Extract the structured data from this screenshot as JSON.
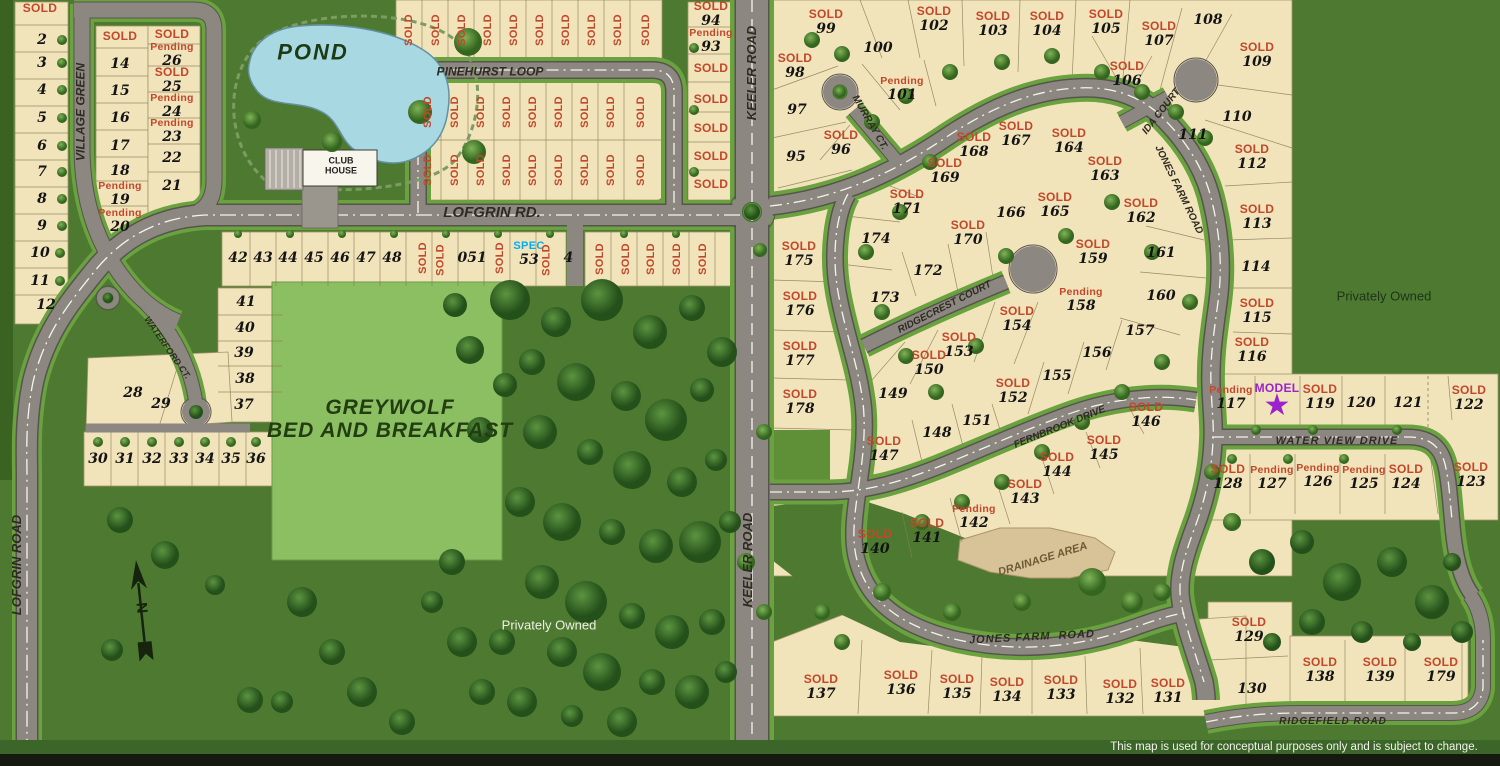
{
  "colors": {
    "background": "#4d7a30",
    "lot_fill": "#f1e3ba",
    "road": "#8d8781",
    "pond": "#a8d8e1",
    "sold": "#c2472b",
    "pending": "#c2472b",
    "spec": "#00aeef",
    "model": "#9a23cc"
  },
  "status_labels": {
    "sold": "SOLD",
    "pending": "Pending",
    "spec": "SPEC",
    "model": "MODEL"
  },
  "privately_owned": {
    "left": "Privately Owned",
    "right": "Privately Owned"
  },
  "disclaimer": "This map is used for conceptual purposes only and is subject to change.",
  "compass": "N",
  "labels": [
    {
      "t": "VILLAGE GREEN",
      "x": 81,
      "y": 112,
      "r": -90,
      "s": 12
    },
    {
      "t": "POND",
      "x": 313,
      "y": 52,
      "s": 22,
      "c": "#1d3a14",
      "sp": 2
    },
    {
      "t": "CLUB",
      "x": 341,
      "y": 161,
      "s": 9,
      "c": "#222",
      "i": false
    },
    {
      "t": "HOUSE",
      "x": 341,
      "y": 171,
      "s": 9,
      "c": "#222",
      "i": false
    },
    {
      "t": "PINEHURST LOOP",
      "x": 490,
      "y": 72,
      "s": 12
    },
    {
      "t": "LOFGRIN RD.",
      "x": 492,
      "y": 213,
      "s": 15
    },
    {
      "t": "WATERFORD CT.",
      "x": 167,
      "y": 348,
      "r": 55,
      "s": 9
    },
    {
      "t": "LOFGRIN ROAD",
      "x": 17,
      "y": 565,
      "r": -90,
      "s": 13
    },
    {
      "t": "KEELER ROAD",
      "x": 752,
      "y": 73,
      "r": -90,
      "s": 13
    },
    {
      "t": "KEELER ROAD",
      "x": 748,
      "y": 560,
      "r": -90,
      "s": 13
    },
    {
      "t": "MURRAY CT.",
      "x": 869,
      "y": 123,
      "r": 60,
      "s": 10
    },
    {
      "t": "IDA COURT",
      "x": 1162,
      "y": 112,
      "r": -52,
      "s": 10
    },
    {
      "t": "JONES FARM ROAD",
      "x": 1178,
      "y": 190,
      "r": 64,
      "s": 10
    },
    {
      "t": "RIDGECREST COURT",
      "x": 945,
      "y": 308,
      "r": -27,
      "s": 10
    },
    {
      "t": "FERNBROOK DRIVE",
      "x": 1060,
      "y": 428,
      "r": -22,
      "s": 10
    },
    {
      "t": "WATER VIEW DRIVE",
      "x": 1337,
      "y": 442,
      "s": 11,
      "sp": 1
    },
    {
      "t": "JONES FARM  ROAD",
      "x": 1032,
      "y": 638,
      "r": -3,
      "s": 11,
      "sp": 1
    },
    {
      "t": "RIDGEFIELD ROAD",
      "x": 1333,
      "y": 722,
      "s": 10,
      "sp": 1
    },
    {
      "t": "DRAINAGE AREA",
      "x": 1043,
      "y": 560,
      "r": -17,
      "s": 11,
      "c": "#6d5a35"
    },
    {
      "t": "GREYWOLF",
      "x": 390,
      "y": 408,
      "s": 21,
      "c": "#223d12",
      "sp": 1
    },
    {
      "t": "BED AND BREAKFAST",
      "x": 390,
      "y": 431,
      "s": 21,
      "c": "#223d12",
      "sp": 1
    }
  ],
  "lots": [
    {
      "s": "sold",
      "x": 40,
      "y": 8
    },
    {
      "n": "2",
      "x": 42,
      "y": 40
    },
    {
      "n": "3",
      "x": 42,
      "y": 63
    },
    {
      "n": "4",
      "x": 42,
      "y": 90
    },
    {
      "n": "5",
      "x": 42,
      "y": 118
    },
    {
      "n": "6",
      "x": 42,
      "y": 146
    },
    {
      "n": "7",
      "x": 42,
      "y": 172
    },
    {
      "n": "8",
      "x": 42,
      "y": 199
    },
    {
      "n": "9",
      "x": 42,
      "y": 226
    },
    {
      "n": "10",
      "x": 40,
      "y": 253
    },
    {
      "n": "11",
      "x": 40,
      "y": 281
    },
    {
      "n": "12",
      "x": 46,
      "y": 305
    },
    {
      "s": "sold",
      "x": 120,
      "y": 36
    },
    {
      "n": "14",
      "x": 120,
      "y": 64
    },
    {
      "n": "15",
      "x": 120,
      "y": 91
    },
    {
      "n": "16",
      "x": 120,
      "y": 118
    },
    {
      "n": "17",
      "x": 120,
      "y": 146
    },
    {
      "n": "18",
      "x": 120,
      "y": 171
    },
    {
      "n": "19",
      "s": "pending",
      "x": 120,
      "y": 194
    },
    {
      "n": "20",
      "s": "pending",
      "x": 120,
      "y": 221
    },
    {
      "s": "sold",
      "x": 172,
      "y": 34
    },
    {
      "n": "26",
      "s": "pending",
      "x": 172,
      "y": 55
    },
    {
      "n": "25",
      "s": "sold",
      "x": 172,
      "y": 80
    },
    {
      "n": "24",
      "s": "pending",
      "x": 172,
      "y": 106
    },
    {
      "n": "23",
      "s": "pending",
      "x": 172,
      "y": 131
    },
    {
      "n": "22",
      "x": 172,
      "y": 158
    },
    {
      "n": "21",
      "x": 172,
      "y": 186
    },
    {
      "s": "sold",
      "x": 409,
      "y": 30,
      "r": -90
    },
    {
      "s": "sold",
      "x": 436,
      "y": 30,
      "r": -90
    },
    {
      "s": "sold",
      "x": 462,
      "y": 30,
      "r": -90
    },
    {
      "s": "sold",
      "x": 488,
      "y": 30,
      "r": -90
    },
    {
      "s": "sold",
      "x": 514,
      "y": 30,
      "r": -90
    },
    {
      "s": "sold",
      "x": 540,
      "y": 30,
      "r": -90
    },
    {
      "s": "sold",
      "x": 566,
      "y": 30,
      "r": -90
    },
    {
      "s": "sold",
      "x": 592,
      "y": 30,
      "r": -90
    },
    {
      "s": "sold",
      "x": 618,
      "y": 30,
      "r": -90
    },
    {
      "s": "sold",
      "x": 646,
      "y": 30,
      "r": -90
    },
    {
      "s": "sold",
      "x": 428,
      "y": 112,
      "r": -90
    },
    {
      "s": "sold",
      "x": 455,
      "y": 112,
      "r": -90
    },
    {
      "s": "sold",
      "x": 481,
      "y": 112,
      "r": -90
    },
    {
      "s": "sold",
      "x": 507,
      "y": 112,
      "r": -90
    },
    {
      "s": "sold",
      "x": 533,
      "y": 112,
      "r": -90
    },
    {
      "s": "sold",
      "x": 559,
      "y": 112,
      "r": -90
    },
    {
      "s": "sold",
      "x": 585,
      "y": 112,
      "r": -90
    },
    {
      "s": "sold",
      "x": 611,
      "y": 112,
      "r": -90
    },
    {
      "s": "sold",
      "x": 641,
      "y": 112,
      "r": -90
    },
    {
      "s": "sold",
      "x": 428,
      "y": 170,
      "r": -90
    },
    {
      "s": "sold",
      "x": 455,
      "y": 170,
      "r": -90
    },
    {
      "s": "sold",
      "x": 481,
      "y": 170,
      "r": -90
    },
    {
      "s": "sold",
      "x": 507,
      "y": 170,
      "r": -90
    },
    {
      "s": "sold",
      "x": 533,
      "y": 170,
      "r": -90
    },
    {
      "s": "sold",
      "x": 559,
      "y": 170,
      "r": -90
    },
    {
      "s": "sold",
      "x": 585,
      "y": 170,
      "r": -90
    },
    {
      "s": "sold",
      "x": 611,
      "y": 170,
      "r": -90
    },
    {
      "s": "sold",
      "x": 641,
      "y": 170,
      "r": -90
    },
    {
      "n": "94",
      "s": "sold",
      "x": 711,
      "y": 14
    },
    {
      "n": "93",
      "s": "pending",
      "x": 711,
      "y": 41
    },
    {
      "s": "sold",
      "x": 711,
      "y": 68
    },
    {
      "s": "sold",
      "x": 711,
      "y": 99
    },
    {
      "s": "sold",
      "x": 711,
      "y": 128
    },
    {
      "s": "sold",
      "x": 711,
      "y": 156
    },
    {
      "s": "sold",
      "x": 711,
      "y": 184
    },
    {
      "n": "42",
      "x": 238,
      "y": 258
    },
    {
      "n": "43",
      "x": 263,
      "y": 258
    },
    {
      "n": "44",
      "x": 288,
      "y": 258
    },
    {
      "n": "45",
      "x": 314,
      "y": 258
    },
    {
      "n": "46",
      "x": 340,
      "y": 258
    },
    {
      "n": "47",
      "x": 366,
      "y": 258
    },
    {
      "n": "48",
      "x": 392,
      "y": 258
    },
    {
      "s": "sold",
      "x": 423,
      "y": 258,
      "r": -90
    },
    {
      "n": "0",
      "s": "sold",
      "x": 446,
      "y": 258,
      "r": -90
    },
    {
      "n": "51",
      "x": 477,
      "y": 258
    },
    {
      "s": "sold",
      "x": 500,
      "y": 258,
      "r": -90
    },
    {
      "n": "53",
      "s": "spec",
      "x": 529,
      "y": 254
    },
    {
      "n": "4",
      "s": "sold",
      "x": 552,
      "y": 258,
      "r": -90
    },
    {
      "s": "sold",
      "x": 600,
      "y": 259,
      "r": -90
    },
    {
      "s": "sold",
      "x": 626,
      "y": 259,
      "r": -90
    },
    {
      "s": "sold",
      "x": 651,
      "y": 259,
      "r": -90
    },
    {
      "s": "sold",
      "x": 677,
      "y": 259,
      "r": -90
    },
    {
      "s": "sold",
      "x": 703,
      "y": 259,
      "r": -90
    },
    {
      "n": "41",
      "x": 246,
      "y": 302
    },
    {
      "n": "40",
      "x": 245,
      "y": 328
    },
    {
      "n": "39",
      "x": 244,
      "y": 353
    },
    {
      "n": "38",
      "x": 245,
      "y": 379
    },
    {
      "n": "37",
      "x": 244,
      "y": 405
    },
    {
      "n": "28",
      "x": 133,
      "y": 393
    },
    {
      "n": "29",
      "x": 161,
      "y": 404
    },
    {
      "n": "30",
      "x": 98,
      "y": 459
    },
    {
      "n": "31",
      "x": 125,
      "y": 459
    },
    {
      "n": "32",
      "x": 152,
      "y": 459
    },
    {
      "n": "33",
      "x": 179,
      "y": 459
    },
    {
      "n": "34",
      "x": 205,
      "y": 459
    },
    {
      "n": "35",
      "x": 231,
      "y": 459
    },
    {
      "n": "36",
      "x": 256,
      "y": 459
    },
    {
      "n": "95",
      "x": 796,
      "y": 157
    },
    {
      "n": "96",
      "s": "sold",
      "x": 841,
      "y": 143
    },
    {
      "n": "97",
      "x": 797,
      "y": 110
    },
    {
      "n": "98",
      "s": "sold",
      "x": 795,
      "y": 66
    },
    {
      "n": "99",
      "s": "sold",
      "x": 826,
      "y": 22
    },
    {
      "n": "100",
      "x": 878,
      "y": 48
    },
    {
      "n": "101",
      "s": "pending",
      "x": 902,
      "y": 89
    },
    {
      "n": "102",
      "s": "sold",
      "x": 934,
      "y": 19
    },
    {
      "n": "103",
      "s": "sold",
      "x": 993,
      "y": 24
    },
    {
      "n": "104",
      "s": "sold",
      "x": 1047,
      "y": 24
    },
    {
      "n": "105",
      "s": "sold",
      "x": 1106,
      "y": 22
    },
    {
      "n": "106",
      "s": "sold",
      "x": 1127,
      "y": 74
    },
    {
      "n": "107",
      "s": "sold",
      "x": 1159,
      "y": 34
    },
    {
      "n": "108",
      "x": 1208,
      "y": 20
    },
    {
      "n": "109",
      "s": "sold",
      "x": 1257,
      "y": 55
    },
    {
      "n": "110",
      "x": 1237,
      "y": 117
    },
    {
      "n": "111",
      "x": 1193,
      "y": 135
    },
    {
      "n": "112",
      "s": "sold",
      "x": 1252,
      "y": 157
    },
    {
      "n": "113",
      "s": "sold",
      "x": 1257,
      "y": 217
    },
    {
      "n": "114",
      "x": 1256,
      "y": 267
    },
    {
      "n": "115",
      "s": "sold",
      "x": 1257,
      "y": 311
    },
    {
      "n": "116",
      "s": "sold",
      "x": 1252,
      "y": 350
    },
    {
      "n": "117",
      "s": "pending",
      "x": 1231,
      "y": 398
    },
    {
      "s": "model",
      "x": 1277,
      "y": 399
    },
    {
      "n": "119",
      "s": "sold",
      "x": 1320,
      "y": 397
    },
    {
      "n": "120",
      "x": 1361,
      "y": 403
    },
    {
      "n": "121",
      "x": 1408,
      "y": 403
    },
    {
      "n": "122",
      "s": "sold",
      "x": 1469,
      "y": 398
    },
    {
      "n": "123",
      "s": "sold",
      "x": 1471,
      "y": 475
    },
    {
      "n": "124",
      "s": "sold",
      "x": 1406,
      "y": 477
    },
    {
      "n": "125",
      "s": "pending",
      "x": 1364,
      "y": 478
    },
    {
      "n": "126",
      "s": "pending",
      "x": 1318,
      "y": 476
    },
    {
      "n": "127",
      "s": "pending",
      "x": 1272,
      "y": 478
    },
    {
      "n": "128",
      "s": "sold",
      "x": 1228,
      "y": 477
    },
    {
      "n": "129",
      "s": "sold",
      "x": 1249,
      "y": 630
    },
    {
      "n": "130",
      "x": 1252,
      "y": 689
    },
    {
      "n": "131",
      "s": "sold",
      "x": 1168,
      "y": 691
    },
    {
      "n": "132",
      "s": "sold",
      "x": 1120,
      "y": 692
    },
    {
      "n": "133",
      "s": "sold",
      "x": 1061,
      "y": 688
    },
    {
      "n": "134",
      "s": "sold",
      "x": 1007,
      "y": 690
    },
    {
      "n": "135",
      "s": "sold",
      "x": 957,
      "y": 687
    },
    {
      "n": "136",
      "s": "sold",
      "x": 901,
      "y": 683
    },
    {
      "n": "137",
      "s": "sold",
      "x": 821,
      "y": 687
    },
    {
      "n": "138",
      "s": "sold",
      "x": 1320,
      "y": 670
    },
    {
      "n": "139",
      "s": "sold",
      "x": 1380,
      "y": 670
    },
    {
      "n": "179",
      "s": "sold",
      "x": 1441,
      "y": 670
    },
    {
      "n": "140",
      "s": "sold",
      "x": 875,
      "y": 542
    },
    {
      "n": "141",
      "s": "sold",
      "x": 927,
      "y": 531
    },
    {
      "n": "142",
      "s": "pending",
      "x": 974,
      "y": 517
    },
    {
      "n": "143",
      "s": "sold",
      "x": 1025,
      "y": 492
    },
    {
      "n": "144",
      "s": "sold",
      "x": 1057,
      "y": 465
    },
    {
      "n": "145",
      "s": "sold",
      "x": 1104,
      "y": 448
    },
    {
      "n": "146",
      "s": "sold",
      "x": 1146,
      "y": 415
    },
    {
      "n": "147",
      "s": "sold",
      "x": 884,
      "y": 449
    },
    {
      "n": "148",
      "x": 937,
      "y": 433
    },
    {
      "n": "149",
      "x": 893,
      "y": 394
    },
    {
      "n": "150",
      "s": "sold",
      "x": 929,
      "y": 363
    },
    {
      "n": "151",
      "x": 977,
      "y": 421
    },
    {
      "n": "152",
      "s": "sold",
      "x": 1013,
      "y": 391
    },
    {
      "n": "153",
      "s": "sold",
      "x": 959,
      "y": 345
    },
    {
      "n": "154",
      "s": "sold",
      "x": 1017,
      "y": 319
    },
    {
      "n": "155",
      "x": 1057,
      "y": 376
    },
    {
      "n": "156",
      "x": 1097,
      "y": 353
    },
    {
      "n": "157",
      "x": 1140,
      "y": 331
    },
    {
      "n": "158",
      "s": "pending",
      "x": 1081,
      "y": 300
    },
    {
      "n": "159",
      "s": "sold",
      "x": 1093,
      "y": 252
    },
    {
      "n": "160",
      "x": 1161,
      "y": 296
    },
    {
      "n": "161",
      "x": 1161,
      "y": 253
    },
    {
      "n": "162",
      "s": "sold",
      "x": 1141,
      "y": 211
    },
    {
      "n": "163",
      "s": "sold",
      "x": 1105,
      "y": 169
    },
    {
      "n": "164",
      "s": "sold",
      "x": 1069,
      "y": 141
    },
    {
      "n": "165",
      "s": "sold",
      "x": 1055,
      "y": 205
    },
    {
      "n": "166",
      "x": 1011,
      "y": 213
    },
    {
      "n": "167",
      "s": "sold",
      "x": 1016,
      "y": 134
    },
    {
      "n": "168",
      "s": "sold",
      "x": 974,
      "y": 145
    },
    {
      "n": "169",
      "s": "sold",
      "x": 945,
      "y": 171
    },
    {
      "n": "170",
      "s": "sold",
      "x": 968,
      "y": 233
    },
    {
      "n": "171",
      "s": "sold",
      "x": 907,
      "y": 202
    },
    {
      "n": "172",
      "x": 928,
      "y": 271
    },
    {
      "n": "173",
      "x": 885,
      "y": 298
    },
    {
      "n": "174",
      "x": 876,
      "y": 239
    },
    {
      "n": "175",
      "s": "sold",
      "x": 799,
      "y": 254
    },
    {
      "n": "176",
      "s": "sold",
      "x": 800,
      "y": 304
    },
    {
      "n": "177",
      "s": "sold",
      "x": 800,
      "y": 354
    },
    {
      "n": "178",
      "s": "sold",
      "x": 800,
      "y": 402
    }
  ]
}
